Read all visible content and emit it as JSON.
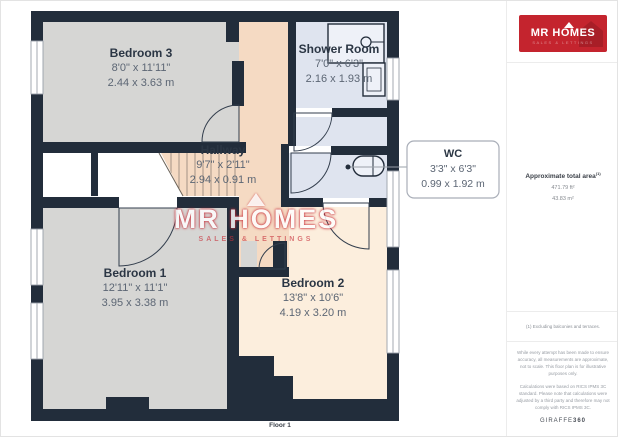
{
  "floorplan": {
    "floor_label": "Floor 1",
    "rooms": {
      "bedroom3": {
        "name": "Bedroom 3",
        "dims_imperial": "8'0\" x 11'11\"",
        "dims_metric": "2.44 x 3.63 m"
      },
      "shower_room": {
        "name": "Shower Room",
        "dims_imperial": "7'0\" x 6'3\"",
        "dims_metric": "2.16 x 1.93 m"
      },
      "hallway": {
        "name": "Hallway",
        "dims_imperial": "9'7\" x 2'11\"",
        "dims_metric": "2.94 x 0.91 m"
      },
      "wc": {
        "name": "WC",
        "dims_imperial": "3'3\" x 6'3\"",
        "dims_metric": "0.99 x 1.92 m"
      },
      "bedroom1": {
        "name": "Bedroom 1",
        "dims_imperial": "12'11\" x 11'1\"",
        "dims_metric": "3.95 x 3.38 m"
      },
      "bedroom2": {
        "name": "Bedroom 2",
        "dims_imperial": "13'8\" x 10'6\"",
        "dims_metric": "4.19 x 3.20 m"
      }
    }
  },
  "watermark": {
    "title": "MR HOMES",
    "subtitle": "SALES & LETTINGS"
  },
  "sidebar": {
    "logo": {
      "title": "MR HOMES",
      "subtitle": "SALES & LETTINGS"
    },
    "area": {
      "label": "Approximate total area",
      "footnote_marker": "(1)",
      "imperial": "471.79 ft²",
      "metric": "43.83 m²"
    },
    "footnote": "(1) Excluding balconies and terraces.",
    "disclaimer1": "While every attempt has been made to ensure accuracy, all measurements are approximate, not to scale. This floor plan is for illustrative purposes only.",
    "disclaimer2": "Calculations were based on RICS IPMS 3C standard. Please note that calculations were adjusted by a third party and therefore may not comply with RICS IPMS 3C.",
    "brand_name": "GIRAFFE",
    "brand_number": "360"
  },
  "colors": {
    "brand_red": "#c4242e",
    "wall": "#222d3b",
    "room_gray": "#d6d6d4",
    "room_blue": "#dfe4ef",
    "hall_peach": "#f5dac3",
    "bed2_peach": "#fceedd"
  }
}
